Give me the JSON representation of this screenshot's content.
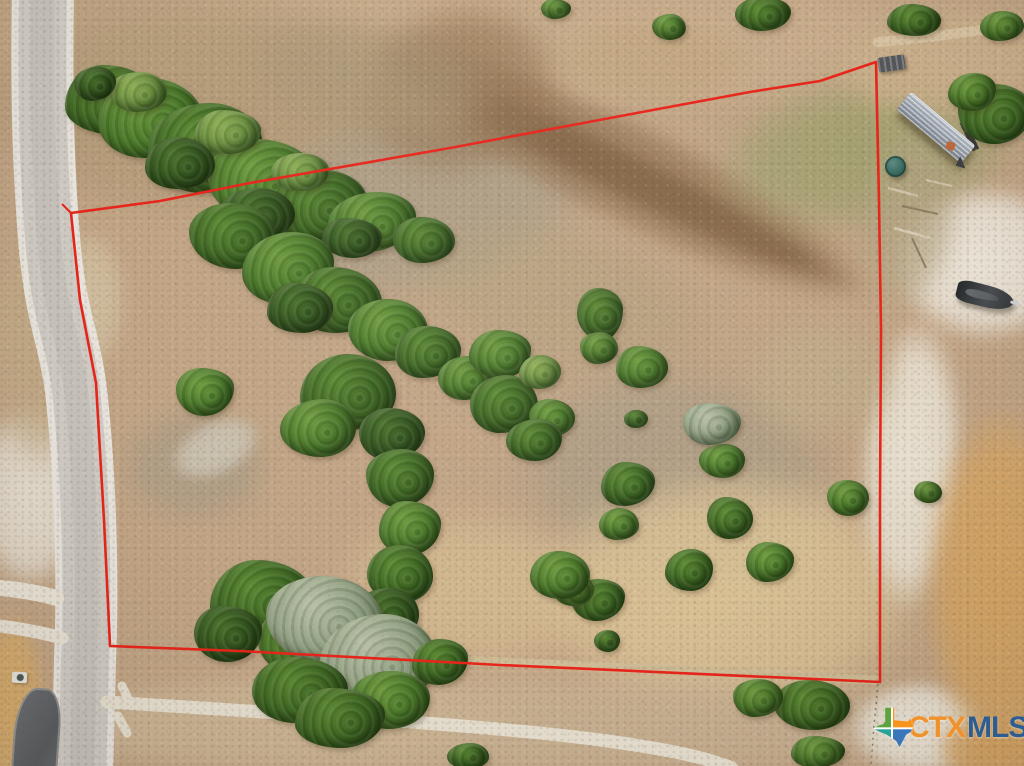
{
  "watermark": {
    "ctx": "CTX",
    "mls": "MLS",
    "ctx_color": "#f0922b",
    "mls_color": "#2d5d90",
    "texas_colors": [
      "#5fa33f",
      "#f7941e",
      "#2aa198",
      "#3a76b9"
    ],
    "x": 872,
    "y": 707
  },
  "boundary": {
    "color": "#e7251b",
    "width": 2.6,
    "points": "71,213 160,201 250,183 450,148 610,118 750,92 820,81 876,62 879,200 881,330 880,500 880,682 500,665 240,651 110,646 104,520 96,383 80,300",
    "tick": "71,213 62,204",
    "fence_points": "878,684 874,725 871,766",
    "fence_color": "#8a8273"
  },
  "scene": {
    "base_color": "#c2a586",
    "road": {
      "path_d": "M 43,-12 C 41,110 44,180 50,250 C 58,330 72,340 78,410 C 86,490 88,590 85,660 C 84,710 83,740 82,780",
      "shoulder_color": "#e9e5de",
      "surface_color": "#d0ccc5",
      "tire_color": "#c0bcb5",
      "w_shoulder": 62,
      "w_surface": 48,
      "w_tire": 24
    },
    "paths": [
      {
        "d": "M 107,702 C 260,712 480,724 600,740 C 660,748 702,756 732,768",
        "w": 13,
        "color": "#e7e0d0"
      },
      {
        "d": "M 122,686 L 130,703",
        "w": 9,
        "color": "#e7e0d0"
      },
      {
        "d": "M 118,716 L 127,733",
        "w": 9,
        "color": "#e7e0d0"
      },
      {
        "d": "M 0,588 C 20,590 40,593 56,598",
        "w": 16,
        "color": "#eae4d7"
      },
      {
        "d": "M 0,626 C 22,629 44,633 62,638",
        "w": 13,
        "color": "#e8e2d5"
      },
      {
        "d": "M 240,648 C 450,660 700,672 876,680",
        "w": 9,
        "color": "#cfbc96"
      },
      {
        "d": "M 878,42 C 930,38 980,30 1026,24",
        "w": 10,
        "color": "#d8c4a2"
      }
    ],
    "junk_lines": [
      {
        "d": "M 888,188 L 918,196",
        "w": 2.5,
        "color": "#cfc3ab"
      },
      {
        "d": "M 902,206 L 938,214",
        "w": 2,
        "color": "#8c7f63"
      },
      {
        "d": "M 894,228 L 930,238",
        "w": 2.5,
        "color": "#d6cbb4"
      },
      {
        "d": "M 912,238 L 926,268",
        "w": 2,
        "color": "#8c7f63"
      },
      {
        "d": "M 926,180 L 952,186",
        "w": 2,
        "color": "#cfc3ab"
      },
      {
        "d": "M 963,122 L 976,150",
        "w": 7,
        "color": "#3a3c38"
      }
    ],
    "patches": [
      [
        512,
        45,
        1080,
        140,
        "#c9ae8d",
        10,
        0.9,
        0
      ],
      [
        200,
        105,
        440,
        230,
        "#b29a77",
        14,
        0.85,
        0
      ],
      [
        410,
        205,
        380,
        190,
        "#a89c87",
        12,
        0.75,
        -10
      ],
      [
        618,
        168,
        560,
        104,
        "#937453",
        8,
        0.8,
        26
      ],
      [
        620,
        172,
        520,
        48,
        "#7d5e40",
        6,
        0.75,
        26
      ],
      [
        460,
        90,
        170,
        210,
        "#937453",
        12,
        0.7,
        75
      ],
      [
        868,
        152,
        300,
        150,
        "#9aa06b",
        16,
        0.75,
        -8
      ],
      [
        560,
        300,
        320,
        150,
        "#b3a07d",
        14,
        0.65,
        15
      ],
      [
        680,
        480,
        340,
        230,
        "#a89b85",
        16,
        0.75,
        10
      ],
      [
        195,
        465,
        150,
        115,
        "#a89b85",
        10,
        0.75,
        0
      ],
      [
        470,
        590,
        260,
        160,
        "#d6bd92",
        14,
        0.8,
        5
      ],
      [
        730,
        595,
        390,
        250,
        "#dcc497",
        14,
        0.9,
        0
      ],
      [
        512,
        728,
        1060,
        110,
        "#c9b294",
        10,
        0.9,
        0
      ],
      [
        290,
        722,
        480,
        95,
        "#cdb695",
        10,
        0.85,
        0
      ],
      [
        985,
        262,
        185,
        155,
        "#efeadf",
        8,
        0.95,
        0
      ],
      [
        912,
        465,
        100,
        290,
        "#ece6d8",
        8,
        0.95,
        3
      ],
      [
        918,
        728,
        135,
        95,
        "#efeade",
        6,
        0.95,
        0
      ],
      [
        1002,
        585,
        155,
        350,
        "#d8a765",
        8,
        0.95,
        0
      ],
      [
        998,
        748,
        125,
        70,
        "#d6a462",
        6,
        0.95,
        0
      ],
      [
        30,
        495,
        115,
        185,
        "#e9e4d8",
        8,
        0.9,
        0
      ],
      [
        12,
        705,
        65,
        185,
        "#d9ad6a",
        6,
        0.9,
        0
      ],
      [
        42,
        335,
        125,
        265,
        "#c3ab87",
        10,
        0.8,
        0
      ],
      [
        950,
        62,
        225,
        115,
        "#cdb28d",
        10,
        0.85,
        -6
      ],
      [
        215,
        448,
        95,
        55,
        "#cfc8b8",
        5,
        0.85,
        -25
      ],
      [
        908,
        220,
        95,
        180,
        "#b3a584",
        10,
        0.75,
        8
      ],
      [
        650,
        62,
        210,
        85,
        "#c2a67f",
        10,
        0.75,
        0
      ],
      [
        370,
        80,
        260,
        120,
        "#ab9878",
        12,
        0.7,
        10
      ],
      [
        820,
        380,
        160,
        120,
        "#bfae8c",
        12,
        0.7,
        0
      ],
      [
        90,
        300,
        70,
        140,
        "#d6c7a9",
        8,
        0.7,
        0
      ]
    ],
    "tree_variants": {
      "v0": {
        "hi": "#4a732c",
        "core": "#33551e",
        "edge": "#223c12"
      },
      "v1": {
        "hi": "#5c8a33",
        "core": "#3f6823",
        "edge": "#2a4a16"
      },
      "v2": {
        "hi": "#6f9c3f",
        "core": "#4c7a2a",
        "edge": "#32551a"
      },
      "v3": {
        "hi": "#8fae55",
        "core": "#6c9140",
        "edge": "#4a6b2a"
      },
      "v4": {
        "hi": "#b9c1a6",
        "core": "#93a284",
        "edge": "#6d7f60"
      }
    },
    "trees": [
      [
        112,
        100,
        95,
        70,
        "v1"
      ],
      [
        150,
        118,
        105,
        80,
        "v2"
      ],
      [
        205,
        148,
        115,
        90,
        "v1"
      ],
      [
        262,
        180,
        108,
        82,
        "v2"
      ],
      [
        318,
        205,
        98,
        72,
        "v1"
      ],
      [
        372,
        222,
        88,
        60,
        "v2"
      ],
      [
        424,
        240,
        62,
        46,
        "v1"
      ],
      [
        138,
        92,
        58,
        40,
        "v3"
      ],
      [
        228,
        132,
        66,
        44,
        "v3"
      ],
      [
        300,
        172,
        58,
        38,
        "v3"
      ],
      [
        95,
        84,
        42,
        34,
        "v0"
      ],
      [
        180,
        163,
        70,
        52,
        "v0"
      ],
      [
        256,
        214,
        78,
        52,
        "v0"
      ],
      [
        352,
        238,
        60,
        40,
        "v0"
      ],
      [
        232,
        236,
        86,
        66,
        "v1"
      ],
      [
        288,
        268,
        92,
        72,
        "v2"
      ],
      [
        338,
        300,
        88,
        66,
        "v1"
      ],
      [
        388,
        330,
        80,
        62,
        "v2"
      ],
      [
        300,
        308,
        66,
        50,
        "v0"
      ],
      [
        428,
        352,
        66,
        52,
        "v1"
      ],
      [
        466,
        378,
        56,
        44,
        "v2"
      ],
      [
        205,
        392,
        58,
        48,
        "v2"
      ],
      [
        348,
        392,
        96,
        76,
        "v1"
      ],
      [
        318,
        428,
        76,
        58,
        "v2"
      ],
      [
        392,
        434,
        66,
        52,
        "v0"
      ],
      [
        400,
        478,
        68,
        58,
        "v1"
      ],
      [
        410,
        528,
        62,
        54,
        "v2"
      ],
      [
        400,
        574,
        66,
        58,
        "v1"
      ],
      [
        386,
        614,
        66,
        52,
        "v0"
      ],
      [
        262,
        600,
        104,
        80,
        "v1"
      ],
      [
        306,
        638,
        96,
        76,
        "v2"
      ],
      [
        228,
        634,
        68,
        56,
        "v0"
      ],
      [
        325,
        620,
        118,
        88,
        "v4"
      ],
      [
        378,
        660,
        118,
        92,
        "v4"
      ],
      [
        300,
        690,
        96,
        66,
        "v1"
      ],
      [
        390,
        700,
        80,
        58,
        "v2"
      ],
      [
        340,
        718,
        90,
        60,
        "v1"
      ],
      [
        500,
        354,
        62,
        48,
        "v2"
      ],
      [
        504,
        404,
        68,
        58,
        "v1"
      ],
      [
        552,
        418,
        46,
        38,
        "v2"
      ],
      [
        540,
        372,
        42,
        34,
        "v3"
      ],
      [
        534,
        440,
        56,
        42,
        "v1"
      ],
      [
        600,
        314,
        46,
        52,
        "v1"
      ],
      [
        599,
        348,
        38,
        32,
        "v2"
      ],
      [
        642,
        367,
        52,
        42,
        "v2"
      ],
      [
        636,
        419,
        24,
        18,
        "v1"
      ],
      [
        722,
        461,
        46,
        34,
        "v2"
      ],
      [
        628,
        484,
        54,
        44,
        "v1"
      ],
      [
        619,
        524,
        40,
        32,
        "v2"
      ],
      [
        730,
        518,
        46,
        42,
        "v1"
      ],
      [
        848,
        498,
        42,
        36,
        "v2"
      ],
      [
        689,
        570,
        48,
        42,
        "v1"
      ],
      [
        770,
        562,
        48,
        40,
        "v2"
      ],
      [
        598,
        600,
        54,
        42,
        "v1"
      ],
      [
        574,
        589,
        40,
        34,
        "v2"
      ],
      [
        560,
        575,
        60,
        48,
        "v2"
      ],
      [
        607,
        641,
        26,
        22,
        "v1"
      ],
      [
        712,
        424,
        58,
        42,
        "v4"
      ],
      [
        440,
        662,
        56,
        46,
        "v1"
      ],
      [
        468,
        756,
        42,
        26,
        "v1"
      ],
      [
        812,
        705,
        76,
        50,
        "v1"
      ],
      [
        758,
        698,
        50,
        38,
        "v2"
      ],
      [
        818,
        752,
        54,
        32,
        "v2"
      ],
      [
        763,
        14,
        56,
        34,
        "v1"
      ],
      [
        669,
        27,
        34,
        26,
        "v2"
      ],
      [
        914,
        20,
        54,
        32,
        "v1"
      ],
      [
        1002,
        26,
        44,
        30,
        "v2"
      ],
      [
        556,
        9,
        30,
        20,
        "v2"
      ],
      [
        995,
        114,
        74,
        60,
        "v1"
      ],
      [
        972,
        92,
        48,
        38,
        "v2"
      ],
      [
        928,
        492,
        28,
        22,
        "v2"
      ]
    ],
    "structures": {
      "trailer": {
        "x": 894,
        "y": 116,
        "w": 84,
        "h": 23,
        "rot": 40
      },
      "tank": {
        "x": 885,
        "y": 156,
        "w": 21,
        "h": 21,
        "rot": 0
      },
      "boat": {
        "x": 956,
        "y": 285,
        "w": 58,
        "h": 22,
        "rot": 14
      },
      "table": {
        "x": 878,
        "y": 56,
        "w": 27,
        "h": 15,
        "rot": -8
      },
      "driveway": {
        "x": 14,
        "y": 688,
        "w": 46,
        "h": 84,
        "rot": 4
      },
      "utilbox": {
        "x": 12,
        "y": 672,
        "w": 15,
        "h": 11,
        "rot": 2
      },
      "brick": {
        "x": 946,
        "y": 142,
        "w": 9,
        "h": 8,
        "rot": 20
      }
    }
  }
}
